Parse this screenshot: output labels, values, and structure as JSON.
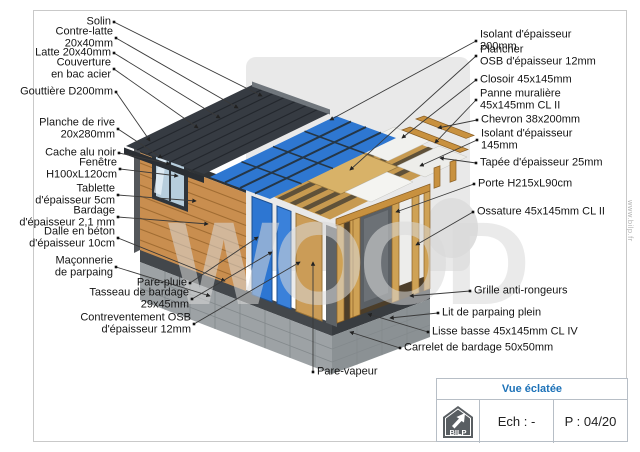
{
  "page": {
    "background": "#ffffff",
    "border_color": "#c9c9c9"
  },
  "colors": {
    "accent_blue": "#1d72b8",
    "insulation_blue": "#2e77d1",
    "wood": "#c98e4f",
    "roof_dark": "#363b42",
    "concrete_gray": "#9da2a5",
    "watermark_gray": "#d9d9d9"
  },
  "watermark": {
    "text": "WOOD",
    "site": "www.bilp.fr"
  },
  "title_block": {
    "title": "Vue éclatée",
    "scale_label": "Ech : -",
    "page_label": "P : 04/20",
    "logo_text": "BILP"
  },
  "callouts": [
    {
      "id": "solin",
      "side": "left",
      "lines": [
        "Solin"
      ],
      "bx": 114,
      "by": 22,
      "tx": 262,
      "ty": 96
    },
    {
      "id": "contre-latte",
      "side": "left",
      "lines": [
        "Contre-latte",
        "20x40mm"
      ],
      "bx": 116,
      "by": 38,
      "tx": 238,
      "ty": 108
    },
    {
      "id": "latte",
      "side": "left",
      "lines": [
        "Latte 20x40mm"
      ],
      "bx": 114,
      "by": 53,
      "tx": 220,
      "ty": 118
    },
    {
      "id": "couverture",
      "side": "left",
      "lines": [
        "Couverture",
        "en bac acier"
      ],
      "bx": 114,
      "by": 69,
      "tx": 198,
      "ty": 128
    },
    {
      "id": "gouttiere",
      "side": "left",
      "lines": [
        "Gouttière D200mm"
      ],
      "bx": 116,
      "by": 92,
      "tx": 150,
      "ty": 141
    },
    {
      "id": "planche-de-rive",
      "side": "left",
      "lines": [
        "Planche de rive",
        "20x280mm"
      ],
      "bx": 118,
      "by": 129,
      "tx": 162,
      "ty": 158
    },
    {
      "id": "cache-alu",
      "side": "left",
      "lines": [
        "Cache alu noir"
      ],
      "bx": 119,
      "by": 153,
      "tx": 170,
      "ty": 164
    },
    {
      "id": "fenetre",
      "side": "left",
      "lines": [
        "Fenêtre",
        "H100xL120cm"
      ],
      "bx": 120,
      "by": 169,
      "tx": 178,
      "ty": 176
    },
    {
      "id": "tablette",
      "side": "left",
      "lines": [
        "Tablette",
        "d'épaisseur 5cm"
      ],
      "bx": 118,
      "by": 195,
      "tx": 196,
      "ty": 201
    },
    {
      "id": "bardage",
      "side": "left",
      "lines": [
        "Bardage",
        "d'épaisseur 2,1 mm"
      ],
      "bx": 118,
      "by": 217,
      "tx": 208,
      "ty": 224
    },
    {
      "id": "dalle",
      "side": "left",
      "lines": [
        "Dalle en béton",
        "d'épaisseur 10cm"
      ],
      "bx": 118,
      "by": 238,
      "tx": 225,
      "ty": 281
    },
    {
      "id": "maconnerie",
      "side": "left",
      "lines": [
        "Maçonnerie",
        "de parpaing"
      ],
      "bx": 116,
      "by": 267,
      "tx": 210,
      "ty": 296
    },
    {
      "id": "pare-pluie",
      "side": "left",
      "lines": [
        "Pare-pluie"
      ],
      "bx": 190,
      "by": 283,
      "tx": 258,
      "ty": 237
    },
    {
      "id": "tasseau",
      "side": "left",
      "lines": [
        "Tasseau de bardage",
        "29x45mm"
      ],
      "bx": 192,
      "by": 299,
      "tx": 272,
      "ty": 252
    },
    {
      "id": "contreventement",
      "side": "left",
      "lines": [
        "Contreventement OSB",
        "d'épaisseur 12mm"
      ],
      "bx": 194,
      "by": 324,
      "tx": 300,
      "ty": 262
    },
    {
      "id": "pare-vapeur",
      "side": "right",
      "lines": [
        "Pare-vapeur"
      ],
      "bx": 313,
      "by": 372,
      "tx": 313,
      "ty": 262
    },
    {
      "id": "isolant-200",
      "side": "right",
      "lines": [
        "Isolant d'épaisseur",
        "200mm"
      ],
      "bx": 476,
      "by": 41,
      "tx": 330,
      "ty": 120
    },
    {
      "id": "plancher",
      "side": "right",
      "lines": [
        "Plancher",
        "OSB d'épaisseur 12mm"
      ],
      "bx": 476,
      "by": 56,
      "tx": 350,
      "ty": 170
    },
    {
      "id": "closoir",
      "side": "right",
      "lines": [
        "Closoir 45x145mm"
      ],
      "bx": 476,
      "by": 80,
      "tx": 402,
      "ty": 138
    },
    {
      "id": "panne",
      "side": "right",
      "lines": [
        "Panne muralière",
        "45x145mm CL II"
      ],
      "bx": 476,
      "by": 100,
      "tx": 435,
      "ty": 143
    },
    {
      "id": "chevron",
      "side": "right",
      "lines": [
        "Chevron 38x200mm"
      ],
      "bx": 477,
      "by": 120,
      "tx": 438,
      "ty": 128
    },
    {
      "id": "isolant-145",
      "side": "right",
      "lines": [
        "Isolant d'épaisseur",
        "145mm"
      ],
      "bx": 477,
      "by": 140,
      "tx": 420,
      "ty": 166
    },
    {
      "id": "tapee",
      "side": "right",
      "lines": [
        "Tapée d'épaisseur 25mm"
      ],
      "bx": 476,
      "by": 163,
      "tx": 440,
      "ty": 158
    },
    {
      "id": "porte",
      "side": "right",
      "lines": [
        "Porte H215xL90cm"
      ],
      "bx": 474,
      "by": 184,
      "tx": 396,
      "ty": 212
    },
    {
      "id": "ossature",
      "side": "right",
      "lines": [
        "Ossature 45x145mm CL II"
      ],
      "bx": 473,
      "by": 212,
      "tx": 416,
      "ty": 245
    },
    {
      "id": "grille",
      "side": "right",
      "lines": [
        "Grille anti-rongeurs"
      ],
      "bx": 470,
      "by": 291,
      "tx": 410,
      "ty": 296
    },
    {
      "id": "lit-parpaing",
      "side": "right",
      "lines": [
        "Lit de parpaing plein"
      ],
      "bx": 438,
      "by": 313,
      "tx": 390,
      "ty": 318
    },
    {
      "id": "lisse-basse",
      "side": "right",
      "lines": [
        "Lisse basse 45x145mm CL IV"
      ],
      "bx": 428,
      "by": 332,
      "tx": 368,
      "ty": 314
    },
    {
      "id": "carrelet",
      "side": "right",
      "lines": [
        "Carrelet de bardage 50x50mm"
      ],
      "bx": 400,
      "by": 348,
      "tx": 350,
      "ty": 332
    }
  ]
}
